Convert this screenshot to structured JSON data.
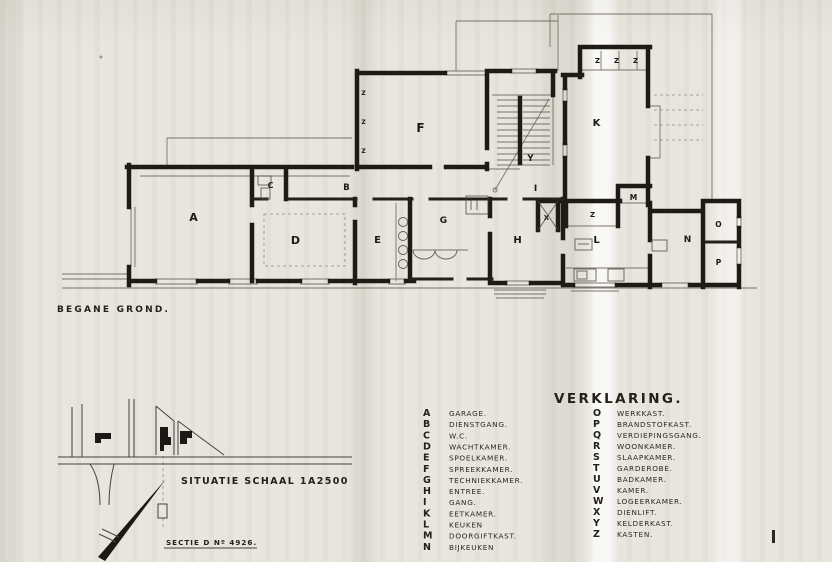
{
  "colors": {
    "paper": "#e8e5de",
    "ink": "#1e1b16",
    "thin_line": "#5b564a"
  },
  "plan": {
    "caption": "BEGANE GROND.",
    "room_labels": [
      {
        "letter": "A"
      },
      {
        "letter": "B"
      },
      {
        "letter": "C"
      },
      {
        "letter": "D"
      },
      {
        "letter": "E"
      },
      {
        "letter": "F"
      },
      {
        "letter": "G"
      },
      {
        "letter": "H"
      },
      {
        "letter": "I"
      },
      {
        "letter": "Y"
      },
      {
        "letter": "K"
      },
      {
        "letter": "L"
      },
      {
        "letter": "M"
      },
      {
        "letter": "N"
      },
      {
        "letter": "O"
      },
      {
        "letter": "P"
      },
      {
        "letter": "X"
      },
      {
        "letter": "Z"
      },
      {
        "letter": "Z"
      },
      {
        "letter": "Z"
      },
      {
        "letter": "Z"
      },
      {
        "letter": "Z"
      },
      {
        "letter": "Z"
      },
      {
        "letter": "Z"
      }
    ]
  },
  "situation": {
    "caption": "SITUATIE  SCHAAL 1A2500",
    "section_label": "SECTIE D Nº 4926."
  },
  "legend": {
    "title": "VERKLARING.",
    "left": [
      {
        "key": "A",
        "label": "GARAGE."
      },
      {
        "key": "B",
        "label": "DIENSTGANG."
      },
      {
        "key": "C",
        "label": "W.C."
      },
      {
        "key": "D",
        "label": "WACHTKAMER."
      },
      {
        "key": "E",
        "label": "SPOELKAMER."
      },
      {
        "key": "F",
        "label": "SPREEKKAMER."
      },
      {
        "key": "G",
        "label": "TECHNIEKKAMER."
      },
      {
        "key": "H",
        "label": "ENTREE."
      },
      {
        "key": "I",
        "label": "GANG."
      },
      {
        "key": "K",
        "label": "EETKAMER."
      },
      {
        "key": "L",
        "label": "KEUKEN"
      },
      {
        "key": "M",
        "label": "DOORGIFTKAST."
      },
      {
        "key": "N",
        "label": "BIJKEUKEN"
      }
    ],
    "right": [
      {
        "key": "O",
        "label": "WERKKAST."
      },
      {
        "key": "P",
        "label": "BRANDSTOFKAST."
      },
      {
        "key": "Q",
        "label": "VERDIEPINGSGANG."
      },
      {
        "key": "R",
        "label": "WOONKAMER."
      },
      {
        "key": "S",
        "label": "SLAAPKAMER."
      },
      {
        "key": "T",
        "label": "GARDEROBE."
      },
      {
        "key": "U",
        "label": "BADKAMER."
      },
      {
        "key": "V",
        "label": "KAMER."
      },
      {
        "key": "W",
        "label": "LOGEERKAMER."
      },
      {
        "key": "X",
        "label": "DIENLIFT."
      },
      {
        "key": "Y",
        "label": "KELDERKAST."
      },
      {
        "key": "Z",
        "label": "KASTEN."
      }
    ]
  }
}
